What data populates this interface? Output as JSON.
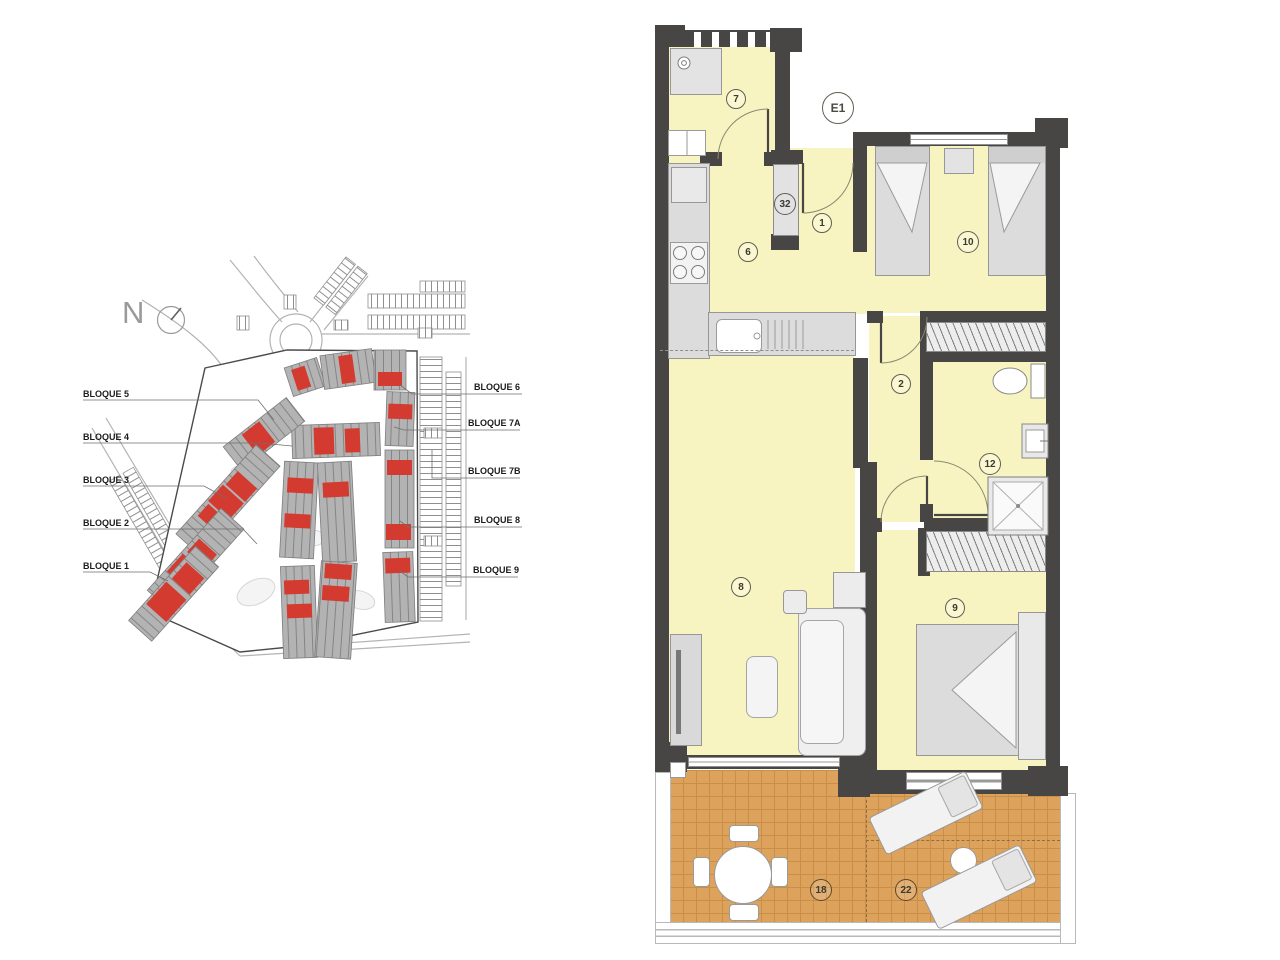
{
  "site_plan": {
    "compass": "N",
    "block_labels_left": [
      "BLOQUE 5",
      "BLOQUE 4",
      "BLOQUE 3",
      "BLOQUE 2",
      "BLOQUE 1"
    ],
    "block_labels_right": [
      "BLOQUE 6",
      "BLOQUE 7A",
      "BLOQUE 7B",
      "BLOQUE 8",
      "BLOQUE 9"
    ]
  },
  "floor_plan": {
    "unit_label": "E1",
    "room_labels": {
      "laundry": "7",
      "duct": "32",
      "entry_hall": "1",
      "kitchen": "6",
      "bedroom_twin": "10",
      "hallway": "2",
      "bathroom": "12",
      "living_room": "8",
      "bedroom_main": "9",
      "terrace_covered": "18",
      "terrace_open": "22"
    }
  },
  "colors": {
    "wall": "#474644",
    "room_fill": "#f8f4c2",
    "terrace_tile": "#dda25c",
    "terrace_grid": "#c98f48",
    "highlight_red": "#d43b30",
    "building_gray": "#b3b3b3",
    "line_gray": "#9a9a9a"
  }
}
